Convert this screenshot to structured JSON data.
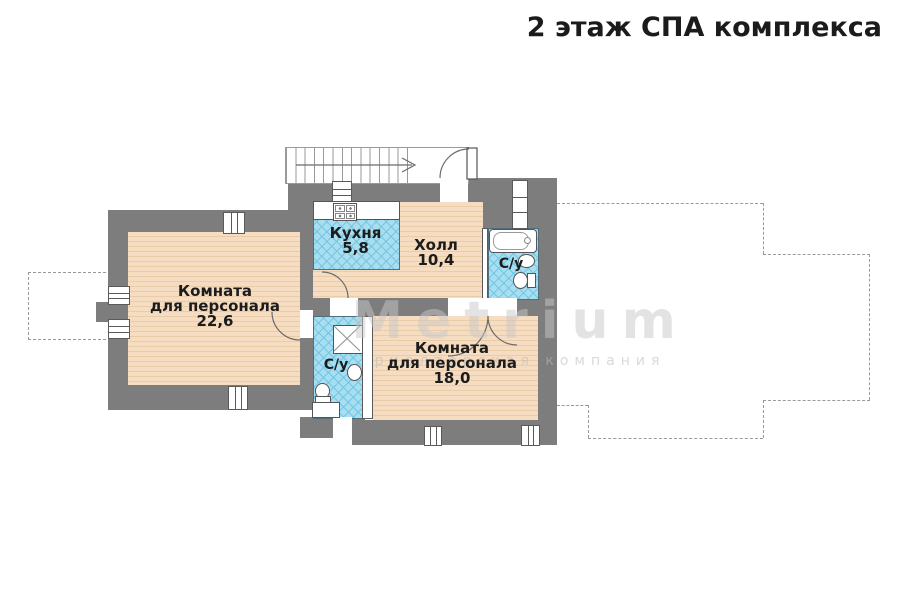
{
  "title": "2 этаж СПА комплекса",
  "watermark": {
    "brand": "Metrium",
    "tagline": "риелторская компания"
  },
  "rooms": {
    "staff_room_1": {
      "name_line1": "Комната",
      "name_line2": "для персонала",
      "area": "22,6"
    },
    "kitchen": {
      "name": "Кухня",
      "area": "5,8"
    },
    "hall": {
      "name": "Холл",
      "area": "10,4"
    },
    "bathroom_top": {
      "name": "С/у"
    },
    "bathroom_center": {
      "name": "С/у"
    },
    "staff_room_2": {
      "name_line1": "Комната",
      "name_line2": "для персонала",
      "area": "18,0"
    }
  },
  "colors": {
    "wall": "#7d7d7d",
    "floor": "#f6ddc2",
    "floor_line": "#e9cda9",
    "tile": "#a9def0",
    "tile_line": "#6ec3e1",
    "outline": "#555555",
    "dashed": "#9a9a9a",
    "title_text": "#1b1b1b",
    "label_text": "#1c1c1c",
    "watermark_text": "#c8c8c8"
  }
}
